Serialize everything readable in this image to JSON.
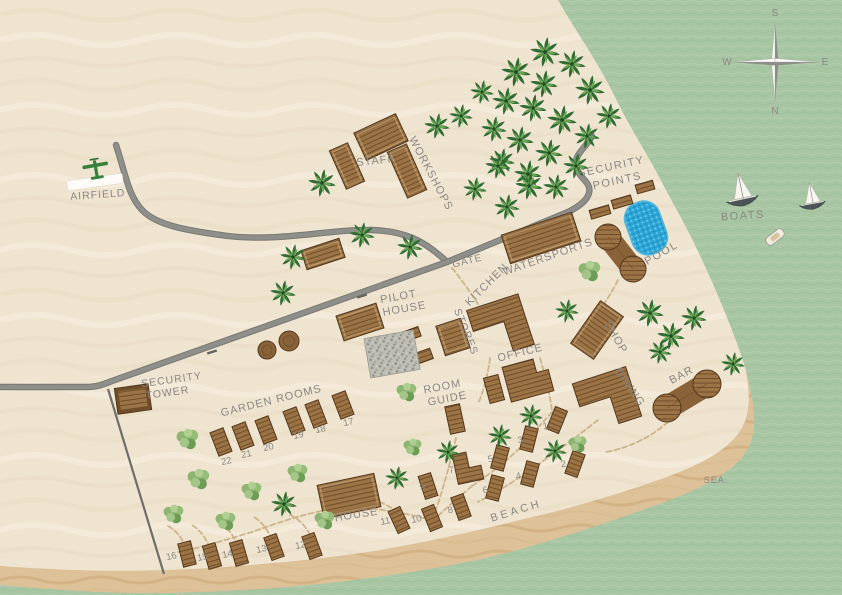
{
  "map": {
    "colors": {
      "sand": "#efe4d0",
      "sand_wave": "#e2d1b2",
      "beach": "#ddc199",
      "beach_wave": "#c8a26f",
      "sea": "#a8c5a4",
      "sea_wave_dark": "#9abf97",
      "sea_wave_light": "#b9d4b4",
      "road": "#8e8e8a",
      "road_casing": "#77776f",
      "fence": "#6e6e6a",
      "trail": "#c9ae83",
      "wood": "#9c7344",
      "wood_line": "#6e4e2b",
      "wood_outline": "#54381c",
      "pool": "#2da7d7",
      "label": "#8a8784",
      "palm_dark": "#2f6b33",
      "palm_light": "#6aa752",
      "plane": "#35803a",
      "runway": "#fcfbf7"
    },
    "sea_path": "M558,0 C575,30 598,62 614,95 C630,128 645,150 658,175 C671,200 684,222 695,245 C706,268 716,290 726,315 C736,340 746,365 751,392 C756,418 756,436 746,452 C733,472 706,486 670,500 C630,515 585,530 532,546 C480,561 430,570 370,578 C305,587 240,591 170,593 C110,594 55,590 0,585 L0,595 L842,595 L842,0 Z",
    "beach_path": "M585,0 C600,28 618,60 632,95 C646,128 658,152 670,178 C681,200 692,222 703,246 C713,268 722,292 731,316 C739,338 745,360 748,385 C750,406 748,420 738,434 C724,452 700,465 664,478 C625,492 580,506 528,518 C476,531 428,542 368,552 C305,561 240,567 170,570 C110,572 55,570 0,566 L0,595 L842,595 L842,0 Z",
    "roads": [
      "M116,145 C126,175 128,196 143,211 C158,226 190,231 228,236 C282,242 330,229 372,230 C404,231 424,240 447,262",
      "M592,136 C586,148 574,154 576,166 C578,178 592,182 589,193 C587,201 578,207 568,212 L447,262 L112,381 C102,385 96,387 86,387 L0,387"
    ],
    "road_ticks": [
      {
        "x": 212,
        "y": 352,
        "rot": 73
      },
      {
        "x": 362,
        "y": 296,
        "rot": 73
      }
    ],
    "fence": {
      "x1": 108,
      "y1": 389,
      "x2": 164,
      "y2": 574
    },
    "trails": [
      "M540,358 C546,378 550,396 552,410",
      "M552,412 C540,426 528,437 520,448",
      "M598,420 C575,438 556,452 536,466 C516,480 498,492 478,502",
      "M520,448 C505,462 490,474 472,486",
      "M472,486 C458,498 446,508 436,518",
      "M456,438 C452,456 448,470 444,484",
      "M444,484 C440,498 436,510 432,520",
      "M668,422 C650,438 628,448 606,452",
      "M618,280 C610,296 600,310 592,322",
      "M452,268 C462,280 470,292 478,304",
      "M490,358 C488,374 484,390 478,404",
      "M432,520 C400,512 370,506 340,508 C308,512 280,522 252,532 C225,540 200,548 178,552",
      "M310,535 C305,525 298,518 288,514",
      "M272,540 C268,530 262,522 254,517",
      "M238,546 C234,536 228,528 220,523",
      "M210,548 C206,538 200,530 192,525",
      "M186,548 C182,538 176,530 168,526",
      "M398,512 C380,500 362,494 346,496"
    ],
    "labels": [
      {
        "name": "airfield",
        "text": "AIRFIELD",
        "x": 98,
        "y": 198,
        "rot": -4,
        "fs": 10.5,
        "ls": 1
      },
      {
        "name": "staff",
        "text": "STAFF",
        "x": 376,
        "y": 164,
        "rot": -6,
        "fs": 11,
        "ls": 1
      },
      {
        "name": "workshops",
        "text": "WORKSHOPS",
        "x": 428,
        "y": 175,
        "rot": 62,
        "fs": 11,
        "ls": 1
      },
      {
        "name": "security-points-1",
        "text": "SECURITY",
        "x": 612,
        "y": 170,
        "rot": -12,
        "fs": 11,
        "ls": 1.5
      },
      {
        "name": "security-points-2",
        "text": "POINTS",
        "x": 618,
        "y": 184,
        "rot": -12,
        "fs": 11,
        "ls": 1.5
      },
      {
        "name": "gate",
        "text": "GATE",
        "x": 468,
        "y": 264,
        "rot": -14,
        "fs": 10,
        "ls": 1
      },
      {
        "name": "kitchen",
        "text": "KITCHEN",
        "x": 489,
        "y": 287,
        "rot": -45,
        "fs": 11,
        "ls": 1
      },
      {
        "name": "watersports",
        "text": "WATERSPORTS",
        "x": 549,
        "y": 260,
        "rot": -19,
        "fs": 11,
        "ls": 1
      },
      {
        "name": "pool",
        "text": "POOL",
        "x": 663,
        "y": 256,
        "rot": -30,
        "fs": 11,
        "ls": 1.5
      },
      {
        "name": "boats",
        "text": "BOATS",
        "x": 743,
        "y": 219,
        "rot": -4,
        "fs": 11,
        "ls": 1.5
      },
      {
        "name": "pilot-house-1",
        "text": "PILOT",
        "x": 399,
        "y": 300,
        "rot": -10,
        "fs": 11,
        "ls": 1
      },
      {
        "name": "pilot-house-2",
        "text": "HOUSE",
        "x": 405,
        "y": 312,
        "rot": -10,
        "fs": 11,
        "ls": 1
      },
      {
        "name": "stores",
        "text": "STORES",
        "x": 463,
        "y": 333,
        "rot": 68,
        "fs": 10.5,
        "ls": 1
      },
      {
        "name": "office",
        "text": "OFFICE",
        "x": 521,
        "y": 356,
        "rot": -14,
        "fs": 11,
        "ls": 1
      },
      {
        "name": "room-guide-1",
        "text": "ROOM",
        "x": 443,
        "y": 390,
        "rot": -11,
        "fs": 11,
        "ls": 1
      },
      {
        "name": "room-guide-2",
        "text": "GUIDE",
        "x": 448,
        "y": 402,
        "rot": -11,
        "fs": 11,
        "ls": 1
      },
      {
        "name": "shop",
        "text": "SHOP",
        "x": 613,
        "y": 339,
        "rot": 60,
        "fs": 11,
        "ls": 1
      },
      {
        "name": "dining",
        "text": "DINING",
        "x": 627,
        "y": 389,
        "rot": 55,
        "fs": 11,
        "ls": 1
      },
      {
        "name": "bar",
        "text": "BAR",
        "x": 683,
        "y": 378,
        "rot": -28,
        "fs": 11,
        "ls": 1
      },
      {
        "name": "security-tower-1",
        "text": "SECURITY",
        "x": 172,
        "y": 383,
        "rot": -8,
        "fs": 10.5,
        "ls": 1
      },
      {
        "name": "security-tower-2",
        "text": "TOWER",
        "x": 168,
        "y": 396,
        "rot": -8,
        "fs": 10.5,
        "ls": 1
      },
      {
        "name": "garden-rooms",
        "text": "GARDEN ROOMS",
        "x": 272,
        "y": 404,
        "rot": -14,
        "fs": 11,
        "ls": 1
      },
      {
        "name": "house",
        "text": "HOUSE",
        "x": 357,
        "y": 518,
        "rot": -9,
        "fs": 11,
        "ls": 1
      },
      {
        "name": "beach",
        "text": "BEACH",
        "x": 517,
        "y": 514,
        "rot": -17,
        "fs": 11,
        "ls": 3
      },
      {
        "name": "sea",
        "text": "SEA.",
        "x": 716,
        "y": 483,
        "rot": 0,
        "fs": 9,
        "ls": 1
      }
    ],
    "compass": {
      "x": 775,
      "y": 62,
      "letters": [
        {
          "t": "S",
          "dx": 0,
          "dy": -46
        },
        {
          "t": "N",
          "dx": 0,
          "dy": 52
        },
        {
          "t": "W",
          "dx": -48,
          "dy": 3
        },
        {
          "t": "E",
          "dx": 50,
          "dy": 3
        }
      ]
    },
    "buildings": [
      {
        "name": "staff-main",
        "kind": "rect",
        "x": 381,
        "y": 137,
        "w": 46,
        "h": 30,
        "rot": -25
      },
      {
        "name": "staff-annex",
        "kind": "rect",
        "x": 347,
        "y": 166,
        "w": 20,
        "h": 42,
        "rot": -24
      },
      {
        "name": "workshops-building",
        "kind": "rect",
        "x": 407,
        "y": 171,
        "w": 21,
        "h": 50,
        "rot": -24
      },
      {
        "name": "north-storage",
        "kind": "rect",
        "x": 323,
        "y": 254,
        "w": 40,
        "h": 20,
        "rot": -18
      },
      {
        "name": "pilot-house-building",
        "kind": "rect",
        "x": 360,
        "y": 322,
        "w": 42,
        "h": 26,
        "rot": -18
      },
      {
        "name": "watersports-building",
        "kind": "rect",
        "x": 541,
        "y": 238,
        "w": 74,
        "h": 30,
        "rot": -18
      },
      {
        "name": "kitchen-building",
        "kind": "path",
        "x": 500,
        "y": 326,
        "rot": -18,
        "d": "M-27,-25 L27,-25 L27,28 L5,28 L5,-3 L-27,-3 Z"
      },
      {
        "name": "stores-building",
        "kind": "rect",
        "x": 453,
        "y": 337,
        "w": 26,
        "h": 31,
        "rot": -18
      },
      {
        "name": "stores-small-a",
        "kind": "rect",
        "x": 412,
        "y": 334,
        "w": 16,
        "h": 10,
        "rot": -20
      },
      {
        "name": "stores-small-b",
        "kind": "rect",
        "x": 424,
        "y": 356,
        "w": 16,
        "h": 11,
        "rot": -20
      },
      {
        "name": "gravel-yard",
        "kind": "gravel",
        "x": 392,
        "y": 354,
        "w": 50,
        "h": 40,
        "rot": -10
      },
      {
        "name": "office-building",
        "kind": "path",
        "x": 528,
        "y": 379,
        "rot": -15,
        "d": "M-22,-18 L10,-18 L10,-4 L22,-4 L22,18 L-22,18 Z"
      },
      {
        "name": "shop-building",
        "kind": "rect",
        "x": 597,
        "y": 330,
        "w": 28,
        "h": 52,
        "rot": 35
      },
      {
        "name": "dining-building",
        "kind": "path",
        "x": 607,
        "y": 400,
        "rot": -18,
        "d": "M-28,-26 L28,-26 L28,26 L4,26 L4,-2 L-28,-2 Z"
      },
      {
        "name": "bar-building",
        "kind": "peanut",
        "x1": 667,
        "y1": 408,
        "x2": 707,
        "y2": 384,
        "r": 14
      },
      {
        "name": "pool-deck",
        "kind": "peanut",
        "x1": 608,
        "y1": 237,
        "x2": 633,
        "y2": 269,
        "r": 13
      },
      {
        "name": "pool-basin",
        "kind": "pool",
        "x": 646,
        "y": 228,
        "w": 36,
        "h": 54,
        "rot": -20
      },
      {
        "name": "security-tower-building",
        "kind": "tower",
        "x": 133,
        "y": 399,
        "w": 34,
        "h": 26,
        "rot": -8
      },
      {
        "name": "security-point-1",
        "kind": "rect",
        "x": 600,
        "y": 212,
        "w": 20,
        "h": 9,
        "rot": -16
      },
      {
        "name": "security-point-2",
        "kind": "rect",
        "x": 622,
        "y": 202,
        "w": 20,
        "h": 9,
        "rot": -16
      },
      {
        "name": "security-point-3",
        "kind": "rect",
        "x": 645,
        "y": 187,
        "w": 18,
        "h": 9,
        "rot": -16
      },
      {
        "name": "round-structure-a",
        "kind": "circle",
        "x": 267,
        "y": 350,
        "r": 9
      },
      {
        "name": "round-structure-b",
        "kind": "circle",
        "x": 289,
        "y": 341,
        "r": 10
      },
      {
        "name": "house-building",
        "kind": "rect",
        "x": 349,
        "y": 496,
        "w": 58,
        "h": 34,
        "rot": -12
      },
      {
        "name": "small-building-a",
        "kind": "rect",
        "x": 494,
        "y": 389,
        "w": 15,
        "h": 26,
        "rot": -15
      },
      {
        "name": "small-building-b",
        "kind": "rect",
        "x": 455,
        "y": 419,
        "w": 15,
        "h": 28,
        "rot": -12
      }
    ],
    "rooms": [
      {
        "n": "1",
        "bx": 557,
        "by": 420,
        "rot": 22,
        "lx": 546,
        "ly": 429
      },
      {
        "n": "2",
        "bx": 575,
        "by": 464,
        "rot": 20,
        "lx": 564,
        "ly": 467
      },
      {
        "n": "3",
        "bx": 529,
        "by": 439,
        "rot": 14,
        "lx": 521,
        "ly": 443
      },
      {
        "n": "4",
        "bx": 530,
        "by": 474,
        "rot": 15,
        "lx": 519,
        "ly": 479
      },
      {
        "n": "5",
        "bx": 500,
        "by": 458,
        "rot": 15,
        "lx": 491,
        "ly": 462
      },
      {
        "n": "6",
        "bx": 495,
        "by": 488,
        "rot": 15,
        "lx": 486,
        "ly": 493
      },
      {
        "n": "7",
        "bx": 468,
        "by": 467,
        "rot": -12,
        "lx": 452,
        "ly": 473,
        "shape": "L"
      },
      {
        "n": "8",
        "bx": 461,
        "by": 507,
        "rot": -20,
        "lx": 451,
        "ly": 513
      },
      {
        "n": "9",
        "bx": 428,
        "by": 486,
        "rot": -18,
        "lx": 423,
        "ly": 490
      },
      {
        "n": "10",
        "bx": 432,
        "by": 518,
        "rot": -22,
        "lx": 417,
        "ly": 522
      },
      {
        "n": "11",
        "bx": 399,
        "by": 520,
        "rot": -25,
        "lx": 386,
        "ly": 524
      },
      {
        "n": "12",
        "bx": 312,
        "by": 546,
        "rot": -20,
        "lx": 301,
        "ly": 548
      },
      {
        "n": "13",
        "bx": 274,
        "by": 547,
        "rot": -20,
        "lx": 262,
        "ly": 552
      },
      {
        "n": "14",
        "bx": 239,
        "by": 553,
        "rot": -16,
        "lx": 228,
        "ly": 557
      },
      {
        "n": "15",
        "bx": 212,
        "by": 556,
        "rot": -16,
        "lx": 203,
        "ly": 560
      },
      {
        "n": "16",
        "bx": 187,
        "by": 554,
        "rot": -14,
        "lx": 172,
        "ly": 559
      },
      {
        "n": "17",
        "bx": 343,
        "by": 405,
        "rot": -21,
        "lx": 349,
        "ly": 425
      },
      {
        "n": "18",
        "bx": 316,
        "by": 414,
        "rot": -21,
        "lx": 321,
        "ly": 432
      },
      {
        "n": "19",
        "bx": 294,
        "by": 421,
        "rot": -21,
        "lx": 299,
        "ly": 438
      },
      {
        "n": "20",
        "bx": 266,
        "by": 430,
        "rot": -21,
        "lx": 269,
        "ly": 450
      },
      {
        "n": "21",
        "bx": 243,
        "by": 436,
        "rot": -21,
        "lx": 247,
        "ly": 457
      },
      {
        "n": "22",
        "bx": 221,
        "by": 442,
        "rot": -21,
        "lx": 227,
        "ly": 464
      }
    ],
    "trees": [
      {
        "t": "palm",
        "x": 545,
        "y": 52,
        "s": 15
      },
      {
        "t": "palm",
        "x": 572,
        "y": 64,
        "s": 14
      },
      {
        "t": "palm",
        "x": 516,
        "y": 72,
        "s": 15
      },
      {
        "t": "palm",
        "x": 544,
        "y": 84,
        "s": 14
      },
      {
        "t": "palm",
        "x": 590,
        "y": 90,
        "s": 15
      },
      {
        "t": "palm",
        "x": 609,
        "y": 116,
        "s": 13
      },
      {
        "t": "palm",
        "x": 506,
        "y": 101,
        "s": 14
      },
      {
        "t": "palm",
        "x": 533,
        "y": 108,
        "s": 14
      },
      {
        "t": "palm",
        "x": 562,
        "y": 120,
        "s": 15
      },
      {
        "t": "palm",
        "x": 587,
        "y": 136,
        "s": 13
      },
      {
        "t": "palm",
        "x": 494,
        "y": 129,
        "s": 13
      },
      {
        "t": "palm",
        "x": 520,
        "y": 140,
        "s": 14
      },
      {
        "t": "palm",
        "x": 549,
        "y": 153,
        "s": 14
      },
      {
        "t": "palm",
        "x": 576,
        "y": 166,
        "s": 13
      },
      {
        "t": "palm",
        "x": 502,
        "y": 161,
        "s": 13
      },
      {
        "t": "palm",
        "x": 528,
        "y": 174,
        "s": 14
      },
      {
        "t": "palm",
        "x": 556,
        "y": 187,
        "s": 13
      },
      {
        "t": "palm",
        "x": 461,
        "y": 116,
        "s": 12
      },
      {
        "t": "palm",
        "x": 482,
        "y": 92,
        "s": 12
      },
      {
        "t": "palm",
        "x": 437,
        "y": 126,
        "s": 13
      },
      {
        "t": "palm",
        "x": 322,
        "y": 183,
        "s": 14
      },
      {
        "t": "palm",
        "x": 293,
        "y": 257,
        "s": 13
      },
      {
        "t": "palm",
        "x": 362,
        "y": 235,
        "s": 13
      },
      {
        "t": "palm",
        "x": 410,
        "y": 247,
        "s": 13
      },
      {
        "t": "palm",
        "x": 283,
        "y": 293,
        "s": 13
      },
      {
        "t": "palm",
        "x": 498,
        "y": 166,
        "s": 13
      },
      {
        "t": "palm",
        "x": 529,
        "y": 186,
        "s": 14
      },
      {
        "t": "palm",
        "x": 507,
        "y": 207,
        "s": 13
      },
      {
        "t": "palm",
        "x": 475,
        "y": 189,
        "s": 12
      },
      {
        "t": "bush",
        "x": 590,
        "y": 271,
        "s": 12
      },
      {
        "t": "palm",
        "x": 567,
        "y": 311,
        "s": 12
      },
      {
        "t": "palm",
        "x": 650,
        "y": 313,
        "s": 14
      },
      {
        "t": "palm",
        "x": 671,
        "y": 336,
        "s": 14
      },
      {
        "t": "palm",
        "x": 694,
        "y": 318,
        "s": 13
      },
      {
        "t": "palm",
        "x": 733,
        "y": 364,
        "s": 12
      },
      {
        "t": "palm",
        "x": 660,
        "y": 352,
        "s": 12
      },
      {
        "t": "bush",
        "x": 407,
        "y": 392,
        "s": 11
      },
      {
        "t": "palm",
        "x": 531,
        "y": 416,
        "s": 12
      },
      {
        "t": "palm",
        "x": 500,
        "y": 436,
        "s": 12
      },
      {
        "t": "palm",
        "x": 448,
        "y": 452,
        "s": 12
      },
      {
        "t": "bush",
        "x": 413,
        "y": 447,
        "s": 10
      },
      {
        "t": "palm",
        "x": 555,
        "y": 451,
        "s": 12
      },
      {
        "t": "bush",
        "x": 578,
        "y": 444,
        "s": 10
      },
      {
        "t": "palm",
        "x": 397,
        "y": 478,
        "s": 12
      },
      {
        "t": "palm",
        "x": 284,
        "y": 504,
        "s": 13
      },
      {
        "t": "bush",
        "x": 188,
        "y": 439,
        "s": 12
      },
      {
        "t": "bush",
        "x": 199,
        "y": 479,
        "s": 12
      },
      {
        "t": "bush",
        "x": 174,
        "y": 514,
        "s": 11
      },
      {
        "t": "bush",
        "x": 226,
        "y": 521,
        "s": 11
      },
      {
        "t": "bush",
        "x": 252,
        "y": 491,
        "s": 11
      },
      {
        "t": "bush",
        "x": 298,
        "y": 473,
        "s": 11
      },
      {
        "t": "bush",
        "x": 325,
        "y": 520,
        "s": 11
      }
    ],
    "boats": [
      {
        "name": "sailboat-large",
        "x": 742,
        "y": 197,
        "scale": 1,
        "rot": -12
      },
      {
        "name": "sailboat-small",
        "x": 812,
        "y": 202,
        "scale": 0.82,
        "rot": -10
      },
      {
        "name": "motorboat",
        "x": 775,
        "y": 237,
        "scale": 1,
        "rot": -38
      }
    ],
    "plane": {
      "x": 96,
      "y": 170,
      "rot": -10
    },
    "runway": {
      "x": 95,
      "y": 182,
      "w": 56,
      "h": 10,
      "rot": -8
    }
  }
}
